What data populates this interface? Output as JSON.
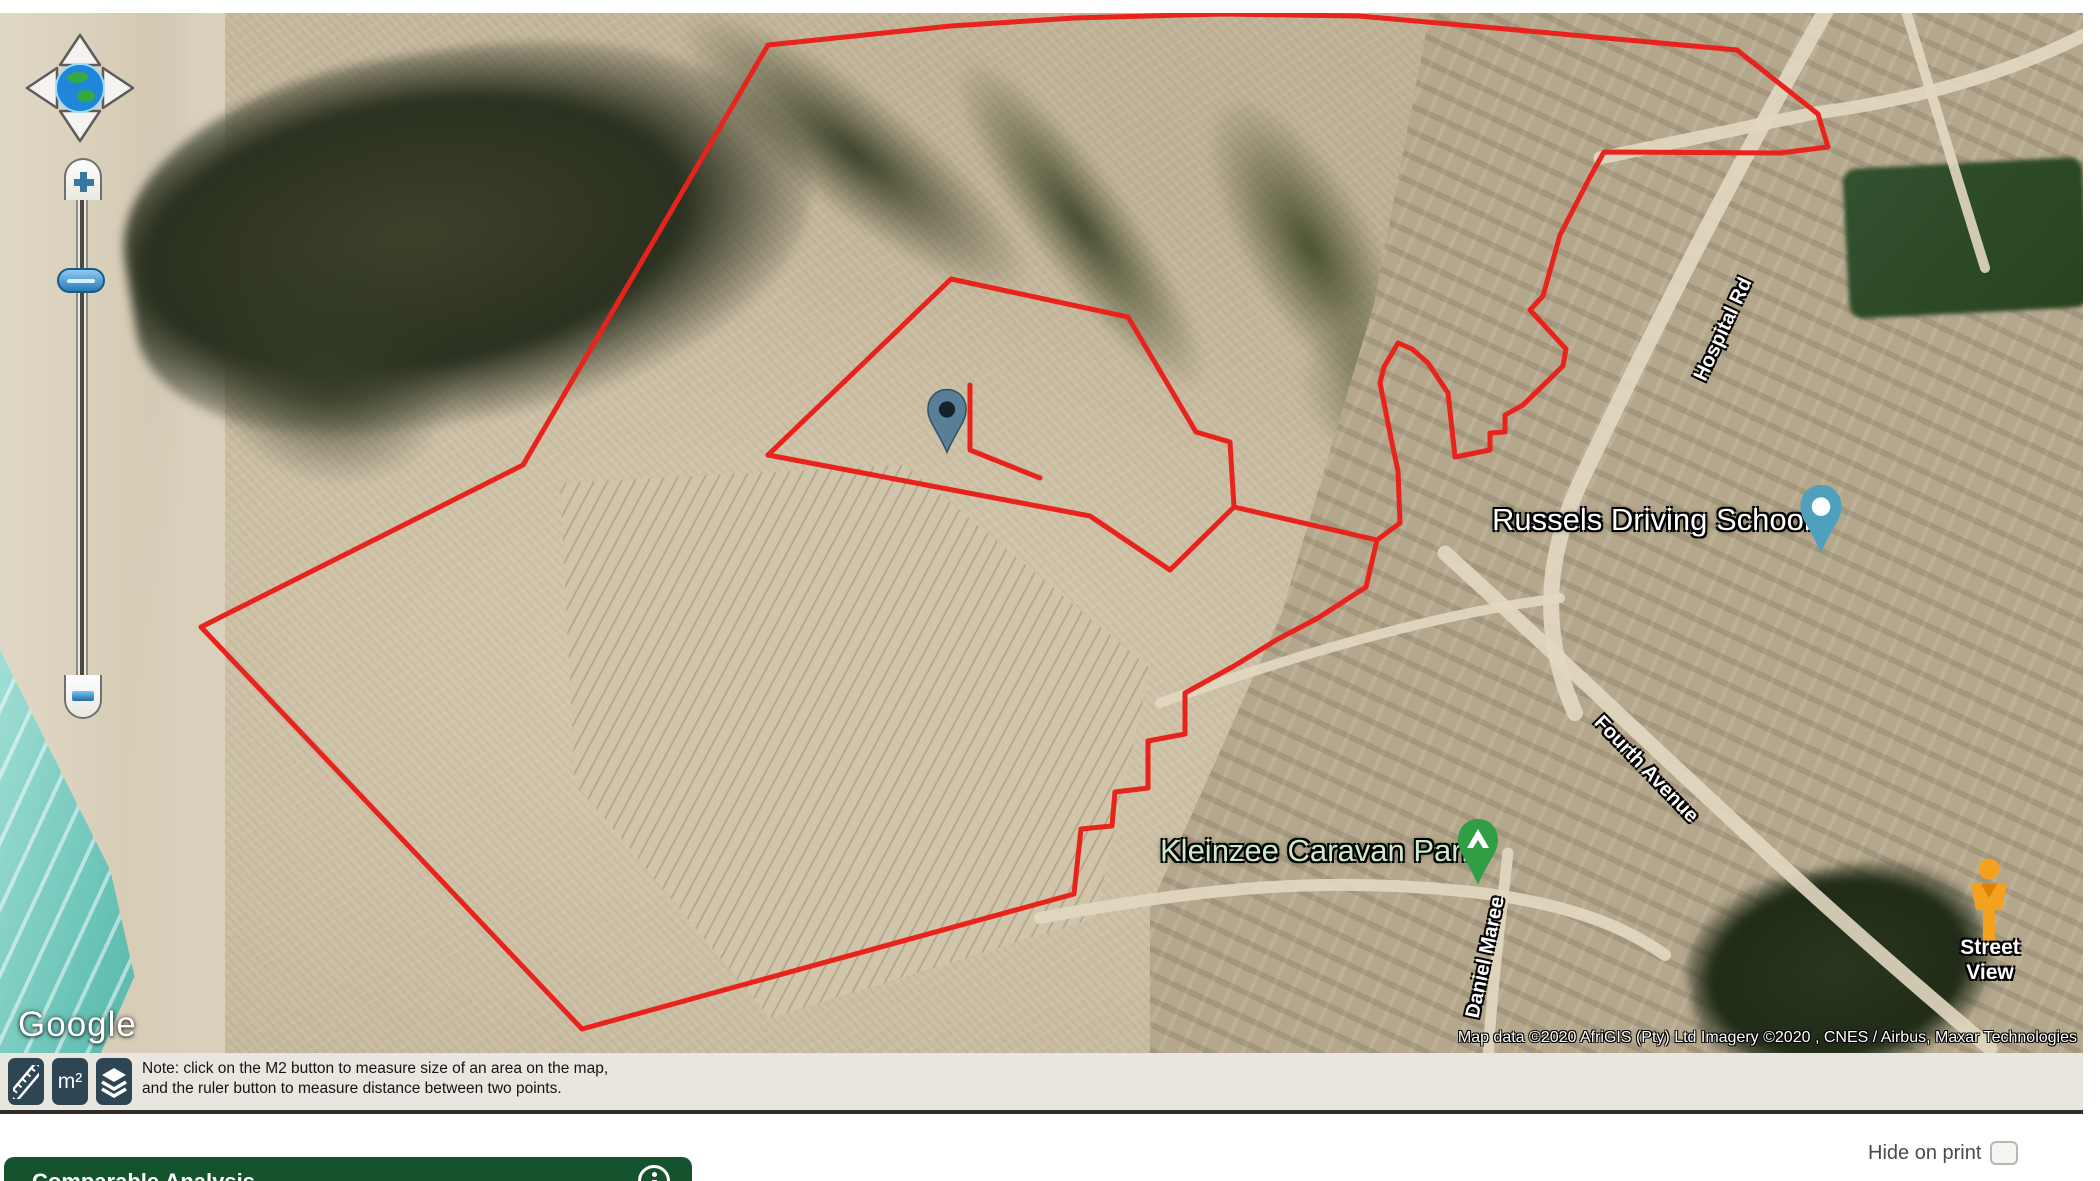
{
  "map": {
    "logo": "Google",
    "attribution": "Map data ©2020 AfriGIS (Pty) Ltd  Imagery ©2020 , CNES / Airbus, Maxar Technologies",
    "labels": {
      "driving_school": "Russels Driving School",
      "caravan_park": "Kleinzee Caravan Park",
      "hospital_rd": "Hospital Rd",
      "fourth_avenue": "Fourth Avenue",
      "daniel_maree": "Daniel Maree",
      "street_view": "Street View"
    },
    "colors": {
      "boundary_red": "#e8231c",
      "ocean_teal": "#66c1b5",
      "pin_slate_blue": "#587e98",
      "poi_pin_teal": "#4fa0bd",
      "poi_pin_green": "#2f9e44",
      "pegman_orange": "#f2a21f"
    },
    "icons": {
      "pan": "compass-pan-icon",
      "zoom_in": "plus-icon",
      "zoom_out": "minus-icon",
      "property_marker": "map-pin-icon",
      "street_view": "street-view-pegman-icon",
      "caravan": "tent-icon"
    }
  },
  "toolbar": {
    "m2_button": "m²",
    "note_line1": "Note: click on the M2 button to measure size of an area on the map,",
    "note_line2": "and the ruler button to measure distance between two points.",
    "icons": {
      "distance": "ruler-icon",
      "area": "m2-icon",
      "layers": "layers-icon"
    },
    "colors": {
      "button_slate": "#2e4653",
      "band_gray": "#e9e6e0"
    }
  },
  "footer": {
    "hide_on_print_label": "Hide on print",
    "section_title": "Comparable Analysis",
    "icons": {
      "info": "info-icon"
    },
    "colors": {
      "header_green": "#14532d"
    }
  }
}
